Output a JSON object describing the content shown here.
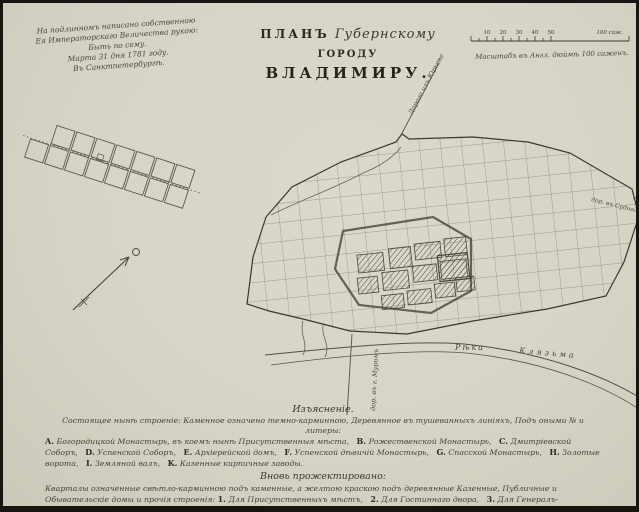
{
  "header": {
    "title_word1": "ПЛАНЪ",
    "title_word2": "Губернскому",
    "title_word3": "ГОРОДУ",
    "title_line2": "ВЛАДИМИРУ."
  },
  "inscription": {
    "line1": "На подлинномъ написано собственною",
    "line2": "Ея Императорскаго Величества рукою:",
    "line3": "Быть по сему.",
    "line4": "Марта 31 дня 1781 году.",
    "line5": "Въ Санктпетербургѣ."
  },
  "scale_bar": {
    "ticks": [
      "10",
      "20",
      "30",
      "40",
      "50"
    ],
    "end_label": "100 саж.",
    "caption": "Масштабъ въ Англ. дюймѣ 100 саженъ."
  },
  "map_labels": {
    "river_word1": "Рѣка",
    "river_word2": "Клязьма",
    "road_top": "Дорога изъ Юрьева",
    "road_bottom": "дор. въ г. Муромъ",
    "road_right": "дор. въ Судогду"
  },
  "legend": {
    "heading": "Изъясненіе.",
    "intro": "Состоящее нынѣ строеніе: Каменное означено темно-карминною, Деревянное въ тушеванныхъ линіяхъ, Подъ оными № и литеры:",
    "items": [
      {
        "key": "A.",
        "label": "Богородицкой Монастырь, въ коемъ нынѣ Присутственныя мѣста,"
      },
      {
        "key": "B.",
        "label": "Рожественской Монастырь,"
      },
      {
        "key": "C.",
        "label": "Дмитріевской Соборъ,"
      },
      {
        "key": "D.",
        "label": "Успенской Соборъ,"
      },
      {
        "key": "E.",
        "label": "Архіерейской домъ,"
      },
      {
        "key": "F.",
        "label": "Успенской дѣвичій Монастырь,"
      },
      {
        "key": "G.",
        "label": "Спасской Монастырь,"
      },
      {
        "key": "H.",
        "label": "Золотые ворота,"
      },
      {
        "key": "I.",
        "label": "Земляной валъ,"
      },
      {
        "key": "K.",
        "label": "Казенные кирпичные заводы."
      }
    ],
    "heading2": "Вновь прожектировано:",
    "intro2": "Кварталы означенные свѣтло-карминною подъ каменные, а желтою краскою подъ деревянные Казенные, Публичные и Обывательскіе домы и прочія строенія:",
    "items2": [
      {
        "key": "1.",
        "label": "Для Присутственныхъ мѣстъ,"
      },
      {
        "key": "2.",
        "label": "Для Гостиннаго двора,"
      },
      {
        "key": "3.",
        "label": "Для Генералъ-Губернаторскаго дома,"
      },
      {
        "key": "4.",
        "label": "Для Губернаторскаго дома,"
      },
      {
        "key": "5.",
        "label": "Для Торговыхъ лавокъ,"
      },
      {
        "key": "6.",
        "label": "Валъ и ровъ въ ограниченіи Города,"
      },
      {
        "key": "7.",
        "label": "Ямская Слобода."
      }
    ]
  }
}
